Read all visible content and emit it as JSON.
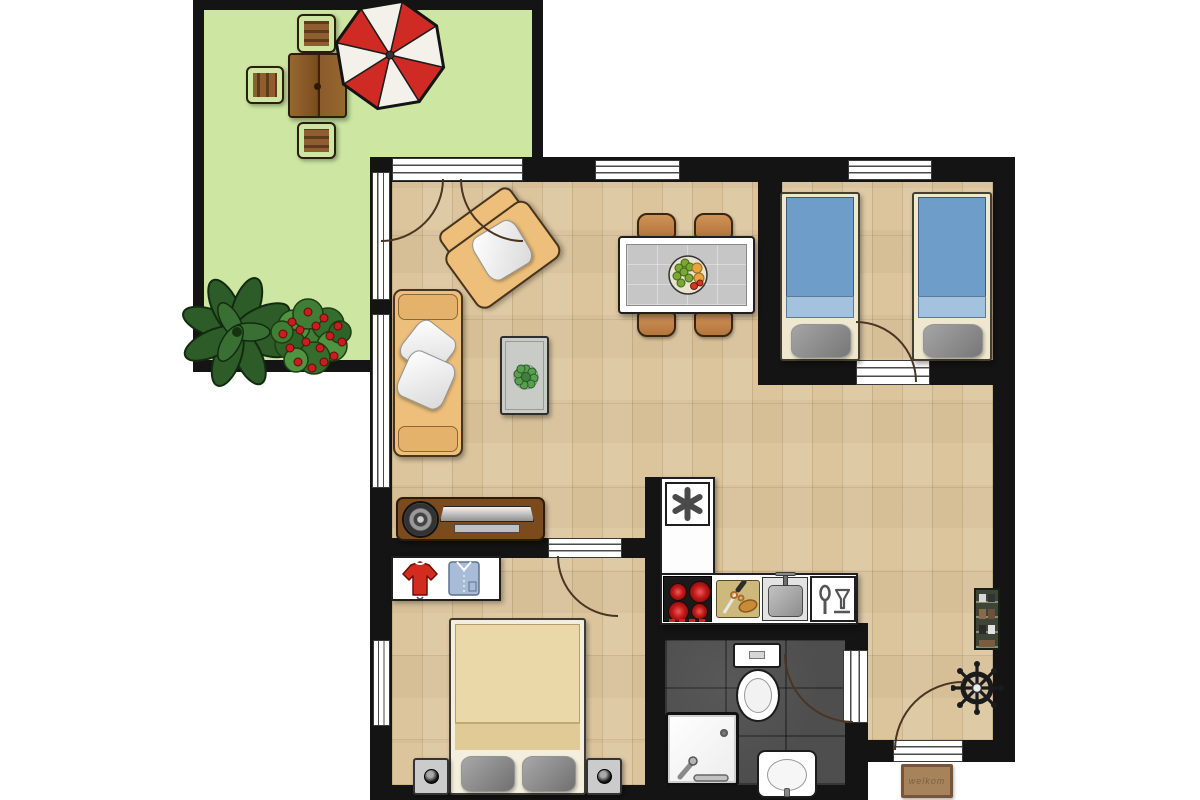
{
  "title": "apartment floor plan",
  "doormat": {
    "text": "welkom"
  },
  "colors": {
    "wall": "#141414",
    "wood": "#dcc59d",
    "terrace": "#cde7a3",
    "bath": "#4e4e4e",
    "sofa": "#edbf7b",
    "bed-blue": "#6d9dc8",
    "bed-blue-light": "#a3c2dd",
    "pillow": "#8f8f8f",
    "blanket": "#ead8a9",
    "table-top": "#c6c6c6",
    "chair": "#cf9257",
    "wood-furn": "#7b4b1d",
    "garden-wood": "#8f5e2f",
    "umb-red": "#cf2b24",
    "plant": "#2d5c28",
    "bush": "#3f7f35",
    "flower": "#c81e1e",
    "sweater": "#d22b1f",
    "shirt": "#a8bcd8",
    "mat": "#a6835b",
    "stove": "#1a1a1a",
    "board": "#cdb97b",
    "steel": "#a8a8a8"
  },
  "floorplan": {
    "rooms": [
      {
        "name": "terrace",
        "furniture": [
          "garden-table",
          "garden-chair",
          "garden-chair",
          "garden-chair",
          "parasol",
          "leaf-plant",
          "flower-bush"
        ]
      },
      {
        "name": "living-dining-room",
        "furniture": [
          "sofa",
          "armchair",
          "coffee-table",
          "tv-lowboard",
          "dining-table",
          "dining-chair",
          "dining-chair",
          "dining-chair",
          "dining-chair",
          "fruit-bowl"
        ]
      },
      {
        "name": "twin-bedroom",
        "furniture": [
          "single-bed",
          "single-bed"
        ]
      },
      {
        "name": "double-bedroom",
        "furniture": [
          "wardrobe",
          "double-bed",
          "nightstand",
          "nightstand"
        ]
      },
      {
        "name": "kitchen",
        "furniture": [
          "fridge-freezer",
          "counter",
          "stove",
          "cutting-board",
          "sink",
          "dishwasher"
        ]
      },
      {
        "name": "bathroom",
        "furniture": [
          "toilet",
          "shower",
          "washbasin"
        ]
      },
      {
        "name": "hallway",
        "furniture": [
          "shoe-rack",
          "coat-stand",
          "entrance-door",
          "doormat"
        ]
      }
    ]
  }
}
